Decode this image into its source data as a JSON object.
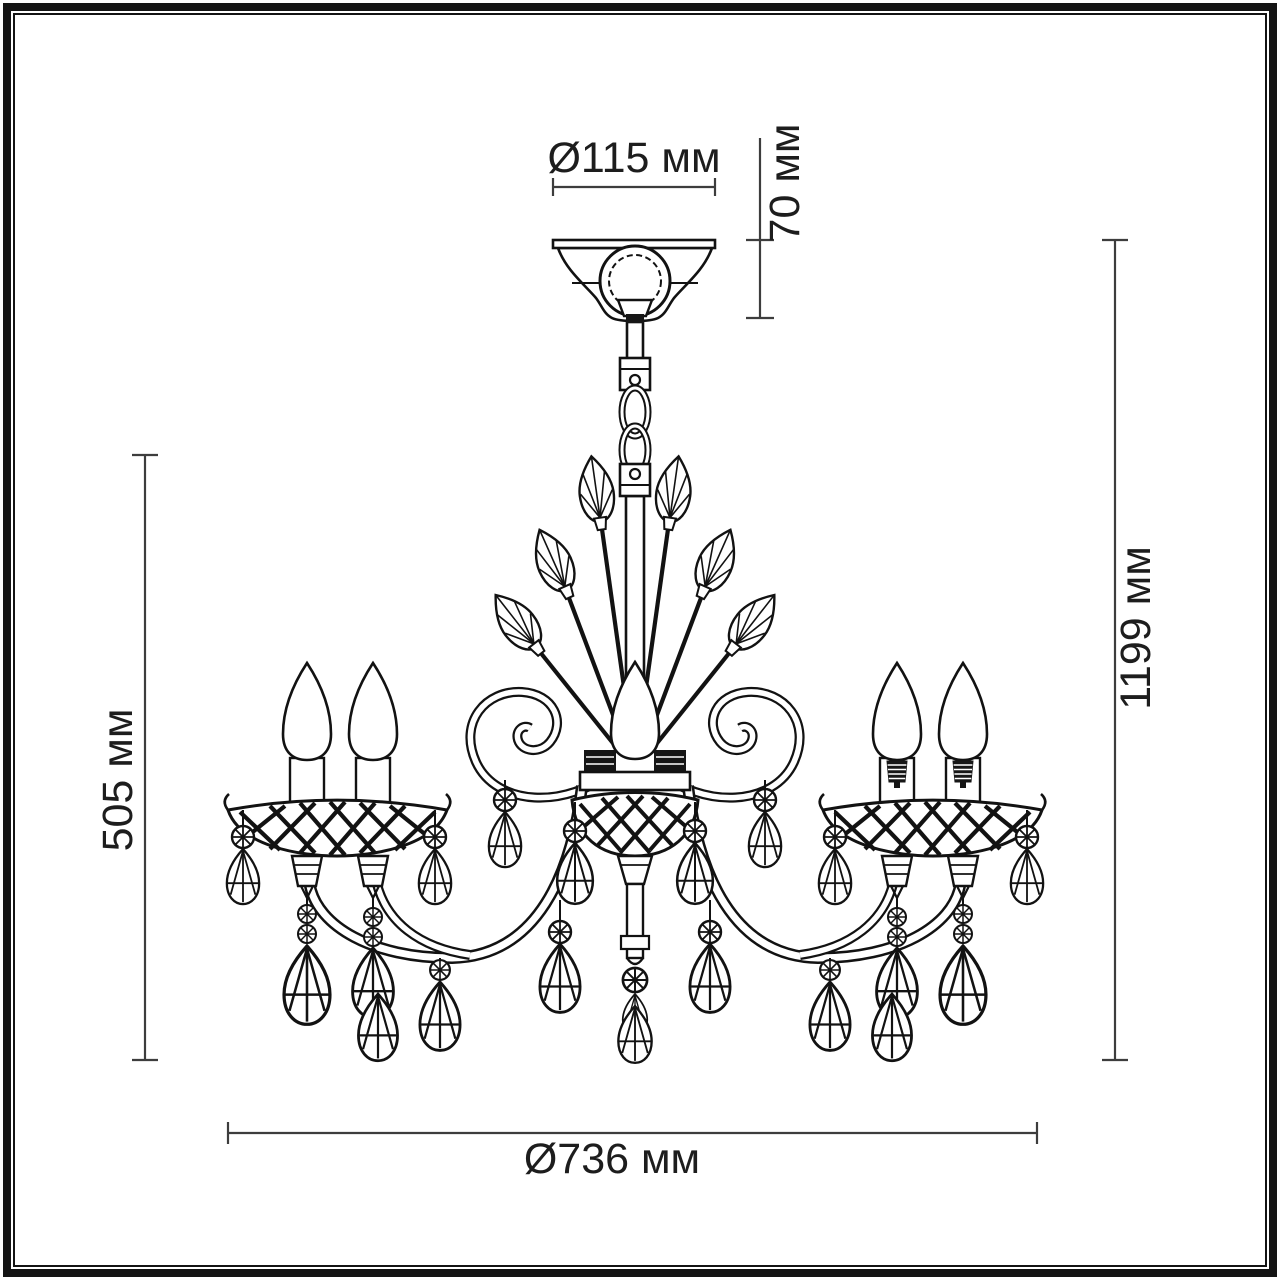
{
  "figure": {
    "type": "technical-line-drawing",
    "subject": "5-light crystal chandelier, front elevation with overall dimensions",
    "parts": [
      "ceiling-canopy",
      "chain-suspension",
      "center-column",
      "leaf-sprays",
      "scroll-ornaments",
      "candle-lights",
      "lattice-bobeches",
      "crystal-teardrops"
    ],
    "colors": {
      "line": "#121212",
      "dimension_line": "#3d3d3d",
      "text": "#1d1d1d",
      "background": "#ffffff"
    }
  },
  "labels": {
    "canopy_diameter": "Ø115 мм",
    "canopy_height": "70 мм",
    "total_height": "1199 мм",
    "body_height": "505 мм",
    "total_diameter": "Ø736 мм"
  }
}
